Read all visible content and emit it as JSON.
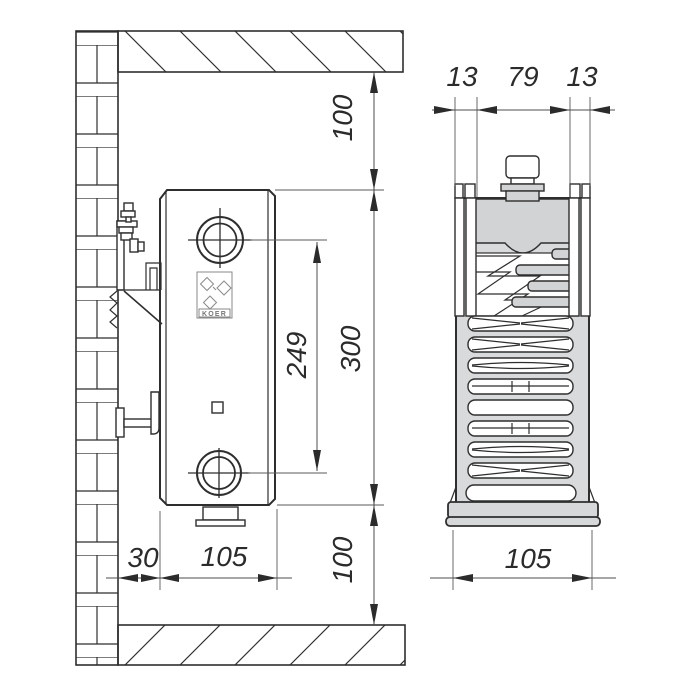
{
  "drawing_type": "radiator installation dimensions diagram",
  "logo_text": "KOER",
  "side_view": {
    "top_clearance": "100",
    "radiator_height": "300",
    "pipe_spacing": "249",
    "bottom_clearance": "100",
    "wall_offset": "30",
    "radiator_depth": "105"
  },
  "profile_view": {
    "front_panel_width": "13",
    "core_width": "79",
    "back_panel_width": "13",
    "overall_depth": "105"
  },
  "colors": {
    "line": "#2e2e2e",
    "dimension_line": "#4d4d4d",
    "light_gray_fill": "#d7d8da",
    "mid_gray_fill": "#d2d3d5",
    "background": "#ffffff"
  }
}
